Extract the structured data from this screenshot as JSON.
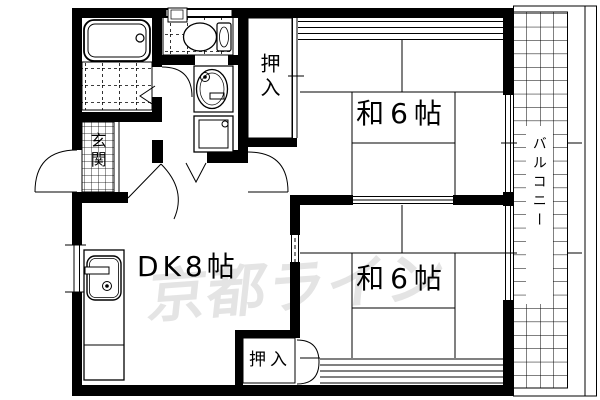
{
  "floorplan": {
    "type": "apartment-2dk-floor-plan",
    "background": "#ffffff",
    "line_color": "#000000",
    "watermark": {
      "text": "京都ライン",
      "color": "#e4e4e4"
    },
    "rooms": {
      "washitsu_top": {
        "label": "和6帖"
      },
      "washitsu_bottom": {
        "label": "和6帖"
      },
      "dining_kitchen": {
        "label": "DK8帖"
      },
      "genkan": {
        "label": "玄関"
      },
      "closet_top": {
        "label": "押入"
      },
      "closet_bottom": {
        "label": "押入"
      },
      "balcony": {
        "label": "バルコニー"
      }
    },
    "fixtures": [
      "bathtub",
      "bath-tile-floor",
      "toilet",
      "corner-hand-basin",
      "wash-basin",
      "washing-machine-pan",
      "kitchen-sink-counter",
      "entrance-door",
      "bath-door",
      "hinged-doors",
      "sliding-fusuma-doors",
      "windows",
      "balcony-grid"
    ]
  }
}
